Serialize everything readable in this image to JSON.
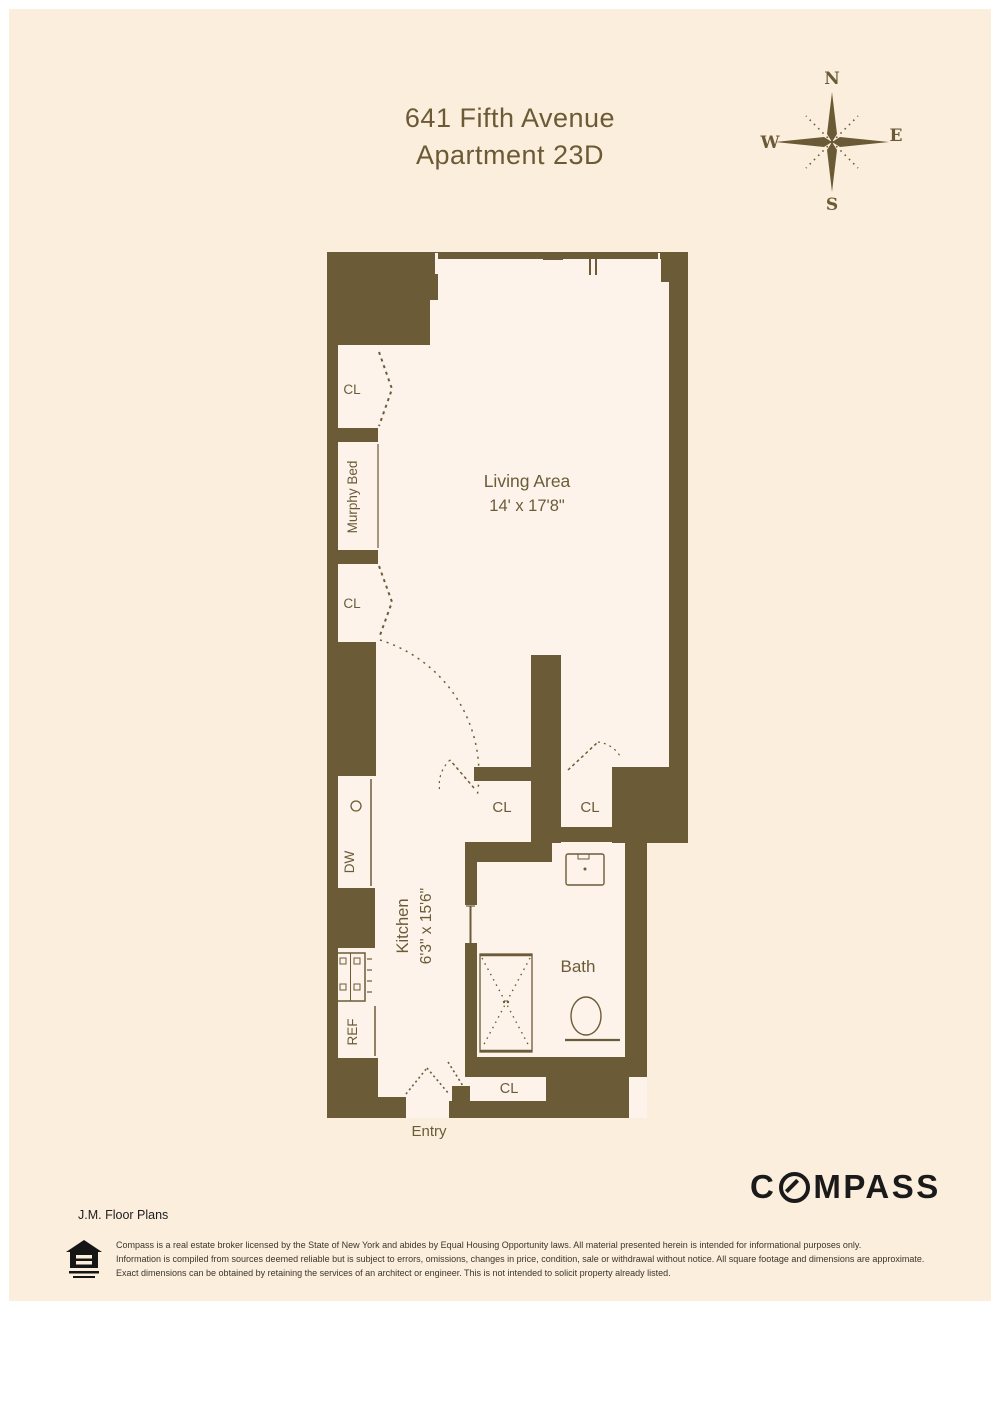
{
  "header": {
    "address": "641 Fifth Avenue",
    "unit": "Apartment 23D"
  },
  "compass_rose": {
    "north": "N",
    "east": "E",
    "south": "S",
    "west": "W"
  },
  "plan": {
    "living_area": {
      "label": "Living Area",
      "dimensions": "14' x 17'8\""
    },
    "kitchen": {
      "label": "Kitchen",
      "dimensions": "6'3\" x 15'6\""
    },
    "bath": {
      "label": "Bath"
    },
    "entry": {
      "label": "Entry"
    },
    "murphy_bed": {
      "label": "Murphy Bed"
    },
    "closet": {
      "label": "CL"
    },
    "dishwasher": {
      "label": "DW"
    },
    "refrigerator": {
      "label": "REF"
    }
  },
  "footer": {
    "brand": {
      "text": "COMPASS",
      "prefix": "C",
      "suffix": "MPASS"
    },
    "credit": "J.M. Floor Plans",
    "disclaimer": {
      "line1": "Compass is a real estate broker licensed by the State of New York and abides by Equal Housing Opportunity laws. All material presented herein is intended for informational purposes only.",
      "line2": "Information is compiled from sources deemed reliable but is subject to errors, omissions, changes in price, condition, sale or withdrawal without notice. All square footage and dimensions are approximate.",
      "line3": "Exact dimensions can be obtained by retaining the services of an architect or engineer. This is not intended to solicit property already listed."
    }
  },
  "colors": {
    "wall": "#6b5c37",
    "background": "#fbeedd",
    "interior": "#fdf3ea",
    "brand_text": "#1a1a1a"
  }
}
